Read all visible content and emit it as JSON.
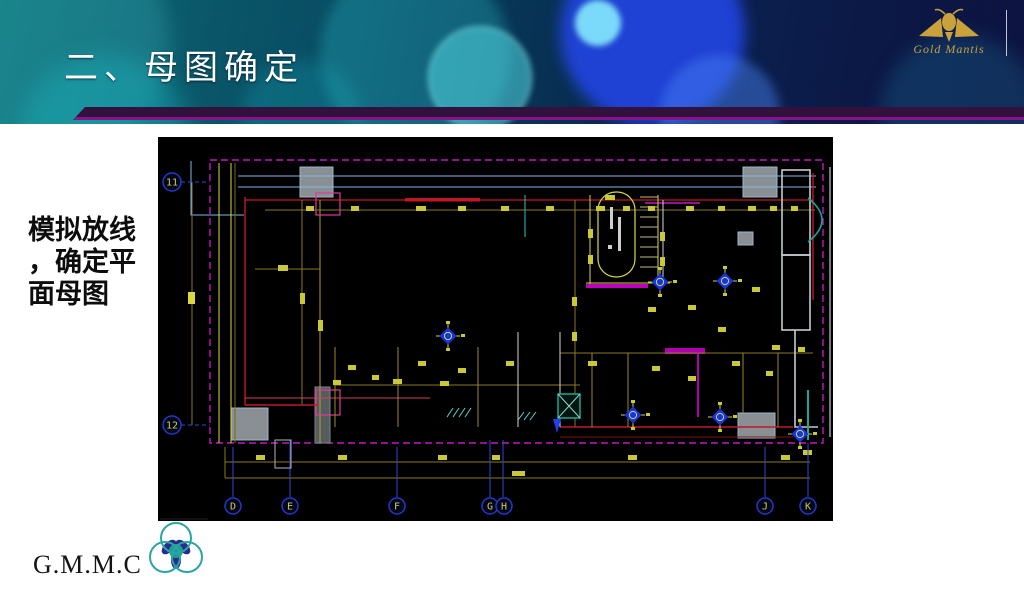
{
  "header": {
    "title": "二、母图确定",
    "logo_text": "Gold Mantis"
  },
  "note": {
    "line1": "模拟放线",
    "line2": "，确定平",
    "line3": "面母图"
  },
  "cad": {
    "description": "模拟放线平面母图 CAD 图",
    "grid_left": {
      "r11": "11",
      "r12": "12"
    },
    "grid_bottom": {
      "d": "D",
      "e": "E",
      "f": "F",
      "g": "G",
      "h": "H",
      "j": "J",
      "k": "K"
    }
  },
  "footer": {
    "brand": "G.M.M.C"
  }
}
